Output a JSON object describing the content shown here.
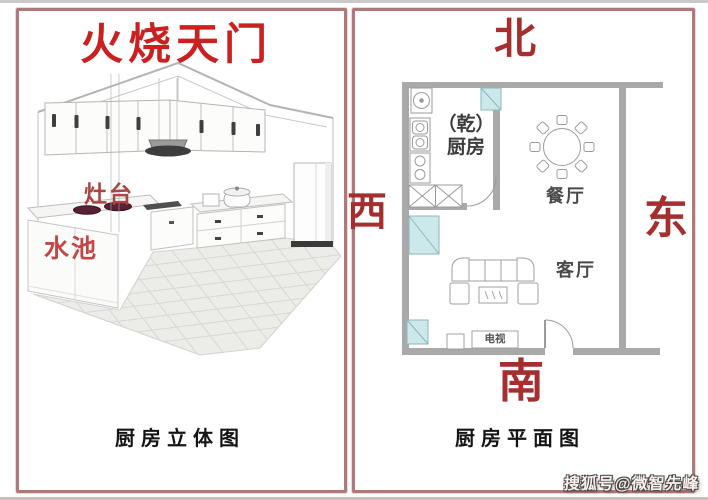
{
  "colors": {
    "panel_border": "#b07878",
    "title_red": "#cb2020",
    "direction_red": "#a52e2e",
    "stove_red": "#a84545",
    "sink_red": "#c34747",
    "wall_gray": "#a9a9a9",
    "window_cyan": "#cde8ea",
    "burner_maroon": "#5a2135"
  },
  "left_panel": {
    "title": "火烧天门",
    "stove_label": "灶台",
    "sink_label": "水池",
    "caption": "厨房立体图"
  },
  "right_panel": {
    "direction_north": "北",
    "direction_west": "西",
    "direction_east": "东",
    "direction_south": "南",
    "kitchen_label_line1": "（乾）",
    "kitchen_label_line2": "厨房",
    "dining_label": "餐厅",
    "living_label": "客厅",
    "tv_label": "电视",
    "caption": "厨房平面图"
  },
  "watermark": "搜狐号@微智先峰"
}
